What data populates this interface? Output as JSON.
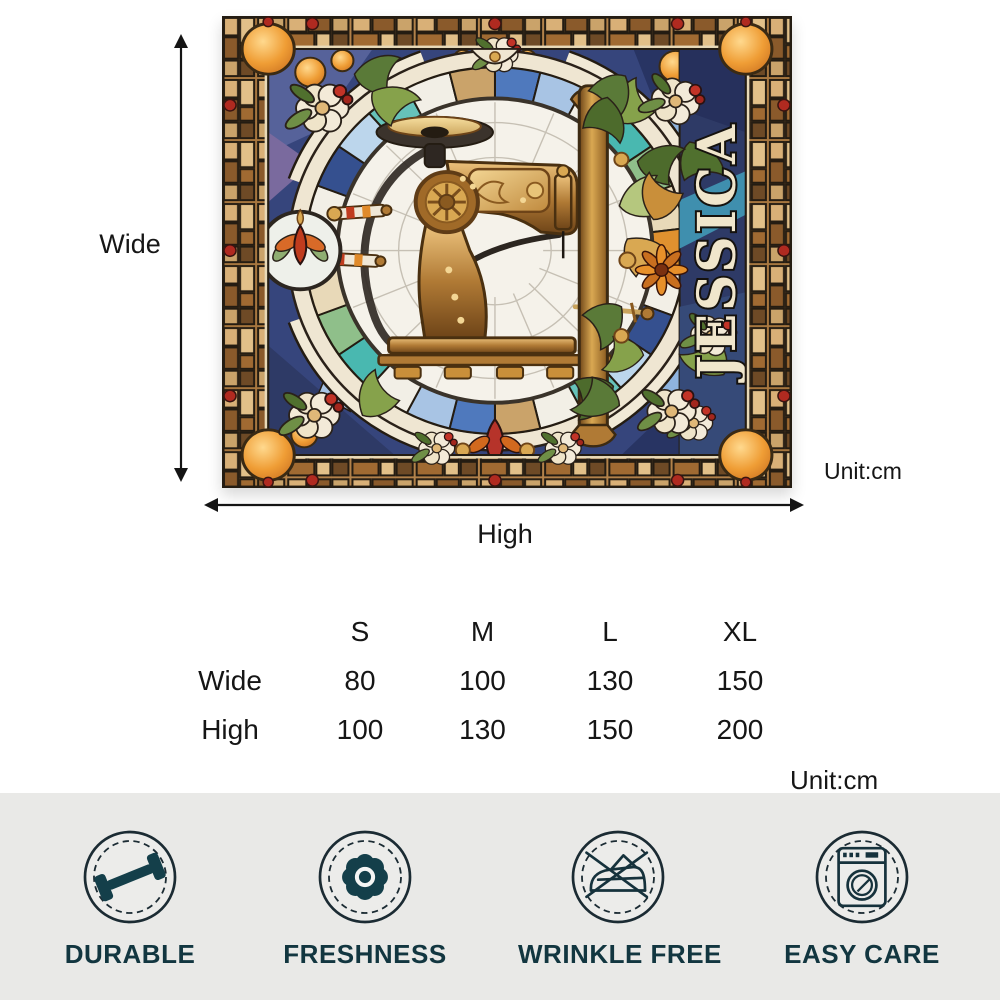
{
  "artwork": {
    "personalized_name": "JESSICA",
    "description": "Stained-glass style artwork of a vintage sewing machine in a mosaic ring medallion",
    "ring_colors": [
      "#4f79bd",
      "#a8c4e4",
      "#f2efe6",
      "#49b8b0",
      "#8fbf8a",
      "#e8d9b8",
      "#e0912f",
      "#f2efe6",
      "#35508f",
      "#bcd6ec",
      "#66c2ba",
      "#f2efe6",
      "#caa36a"
    ],
    "web_color": "#c6c0b4",
    "palette": {
      "lead_line": "#241c12",
      "cream": "#efe6d2",
      "navy_field": "#36457c",
      "orange_glass": "#e0912f",
      "bronze": "#a9702d",
      "name_fill": "#f0e6cc"
    }
  },
  "dimension_labels": {
    "wide": "Wide",
    "high": "High",
    "unit": "Unit:cm"
  },
  "size_table": {
    "columns": [
      "S",
      "M",
      "L",
      "XL"
    ],
    "rows": [
      {
        "label": "Wide",
        "values": [
          "80",
          "100",
          "130",
          "150"
        ]
      },
      {
        "label": "High",
        "values": [
          "100",
          "130",
          "150",
          "200"
        ]
      }
    ],
    "unit": "Unit:cm"
  },
  "features": [
    {
      "label": "DURABLE",
      "icon": "dumbbell-icon"
    },
    {
      "label": "FRESHNESS",
      "icon": "flower-icon"
    },
    {
      "label": "WRINKLE FREE",
      "icon": "no-iron-icon"
    },
    {
      "label": "EASY CARE",
      "icon": "washing-machine-icon"
    }
  ],
  "feature_bar": {
    "background": "#e9e9e7",
    "icon_color": "#143f4a",
    "label_color": "#123640"
  }
}
